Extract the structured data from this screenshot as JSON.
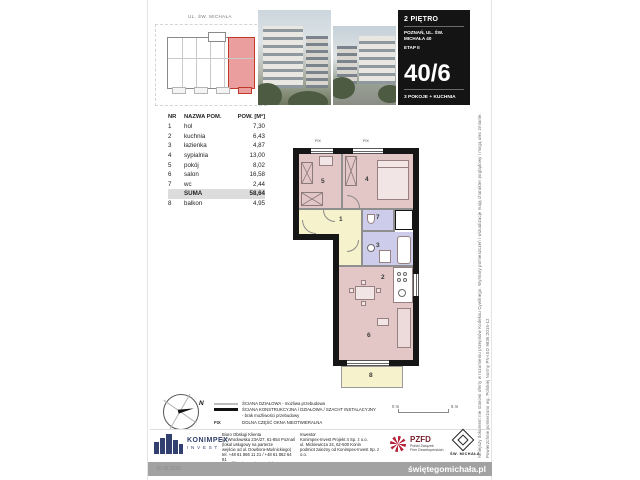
{
  "site_plan": {
    "street_label": "UL. ŚW. MICHAŁA"
  },
  "unit_card": {
    "floor": "2 PIĘTRO",
    "address": "POZNAŃ, UL. ŚW. MICHAŁA 40",
    "stage": "ETAP II",
    "unit": "40/6",
    "layout": "3 POKOJE + KUCHNIA"
  },
  "room_table": {
    "col_nr": "NR",
    "col_name": "NAZWA POM.",
    "col_area": "POW. [M²]",
    "rows": [
      {
        "nr": "1",
        "name": "hol",
        "area": "7,30"
      },
      {
        "nr": "2",
        "name": "kuchnia",
        "area": "6,43"
      },
      {
        "nr": "3",
        "name": "łazienka",
        "area": "4,87"
      },
      {
        "nr": "4",
        "name": "sypialnia",
        "area": "13,00"
      },
      {
        "nr": "5",
        "name": "pokój",
        "area": "8,02"
      },
      {
        "nr": "6",
        "name": "salon",
        "area": "16,58"
      },
      {
        "nr": "7",
        "name": "wc",
        "area": "2,44"
      },
      {
        "nr": "",
        "name": "SUMA",
        "area": "58,64"
      },
      {
        "nr": "8",
        "name": "balkon",
        "area": "4,95"
      }
    ]
  },
  "floor_plan": {
    "labels": {
      "r1": "1",
      "r2": "2",
      "r3": "3",
      "r4": "4",
      "r5": "5",
      "r6": "6",
      "r7": "7",
      "r8": "8"
    },
    "fix": "FIX",
    "compass_n": "N",
    "scale_left": "0 m",
    "scale_right": "5 m"
  },
  "legend": {
    "partition_text": "ŚCIANA DZIAŁOWA - możliwa przebudowa",
    "structural_text": "ŚCIANA KONSTRUKCYJNA / DZIAŁOWA / SZACHT INSTALACYJNY",
    "structural_text2": "- brak możliwości przebudowy",
    "fix_key": "FIX",
    "fix_text": "DOLNA CZĘŚĆ OKNA NIEOTWIERALNA"
  },
  "footer": {
    "brand": {
      "name": "KONIMPEX",
      "sub": "INVEST"
    },
    "office": {
      "title": "Biuro Obsługi Klienta",
      "line1": "ul. Wrocławska 23A/27, 61-854 Poznań",
      "line2": "(lokal usługowy na parterze",
      "line3": "wejście od ul. Dowbora-Muśnickiego)",
      "line4": "tel. +48 61 866 11 21 / +48 61 862 64 91",
      "line5": "biuro@konimpex-invest.pl / www.konimpex-invest.pl"
    },
    "investor": {
      "title": "Inwestor",
      "line1": "Konimpex-Invest Projekt 4 Sp. z o.o.",
      "line2": "ul. Mickiewicza 24, 62-500 Konin",
      "line3": "podmiot zależny od Konimpex-Invest Sp. z o.o."
    },
    "pzfd": {
      "abbr": "PZFD",
      "line1": "Polski Związek",
      "line2": "Firm Deweloperskich"
    },
    "estate_logo": "ŚW. MICHAŁA"
  },
  "bottom_bar": {
    "date": "10.06.2020",
    "site": "świętegomichała.pl"
  },
  "disclaimers": {
    "outer": "Powierzchnie pomierzono wg. Polskiej Normy PN-ISO 9836:2015-12",
    "inner": "Niniejszy dokument nie stanowi oferty w rozumieniu przepisów Kodeksu Cywilnego. Wymiary pomieszczeń i wizualizacje mają charakter poglądowy i mogą ulec zmianie."
  }
}
